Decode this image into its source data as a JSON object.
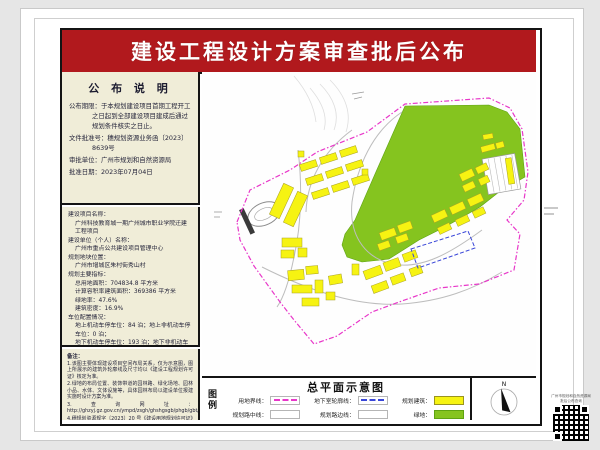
{
  "banner": {
    "title": "建设工程设计方案审查批后公布"
  },
  "notice": {
    "header": "公 布 说 明",
    "period_label": "公布期限：",
    "period_value": "于本规划建设项目首期工程开工之日起到全部建设项目建成后通过规划条件核实之日止。",
    "doc_no_label": "文件批准号：",
    "doc_no_value": "穗规划资源业务函〔2023〕8639号",
    "authority_label": "审批单位：",
    "authority_value": "广州市规划和自然资源局",
    "date_label": "批准日期：",
    "date_value": "2023年07月04日"
  },
  "project": {
    "name_label": "建设项目名称：",
    "name_value": "广州科技教育城一期广州城市职业学院迁建工程项目",
    "unit_label": "建设单位（个人）名称：",
    "unit_value": "广州市重点公共建设项目管理中心",
    "location_label": "规划地块位置：",
    "location_value": "广州市增城区朱村街秀山村",
    "indicators_label": "规划主要指标：",
    "land_area": "总用地面积：704834.8 平方米",
    "floor_area": "计算容积率建筑面积：369386 平方米",
    "green_ratio": "绿地率：47.6%",
    "density": "建筑密度：16.9%",
    "parking_label": "车位配置情况：",
    "parking_line1": "地上机动车停车位：84 泊；地上非机动车停车位：0 泊；",
    "parking_line2": "地下机动车停车位：193 泊；地下非机动车停车位：5992 泊；",
    "public_label": "公建配套项目：",
    "public_value": "无"
  },
  "remarks": {
    "header": "备注：",
    "items": [
      "1.该图主要体现建设项目空间布局关系，仅为示意图，图上所展示的建筑外轮廓线及尺寸均以《建设工程规划许可证》核定为准。",
      "2.绿地的布局位置、装饰带道的园林路、绿化场地、园林小品、水体、文体设施等，具体园林布局以建设单位报建实施时设计方案为准。",
      "3.查询网址： http://ghzyj.gz.gov.cn/ympd/zsgh/ghshgsgb/phgb/gbt/",
      "4.穗规划资源规字〔2023〕20 号《建设用地规划许可证》所规定其他范围内需建设工程规划许可的以穗规划资源业务函〔2023〕8639 号批复方案为准。"
    ]
  },
  "plan": {
    "title": "总平面示意图"
  },
  "legend": {
    "label": "图例",
    "items": [
      {
        "name": "用地界线：",
        "type": "dash-magenta",
        "color": "#e837c9"
      },
      {
        "name": "地下室轮廓线：",
        "type": "dash-blue",
        "color": "#3946d8"
      },
      {
        "name": "规划建筑：",
        "type": "fill",
        "color": "#f6f312"
      },
      {
        "name": "规划路中线：",
        "type": "box",
        "color": "#ffffff"
      },
      {
        "name": "规划路边线：",
        "type": "box",
        "color": "#ffffff"
      },
      {
        "name": "绿地：",
        "type": "fill",
        "color": "#85c41f"
      }
    ],
    "north_label": "N"
  },
  "qr": {
    "caption_line1": "广州市规划和自然资源局",
    "caption_line2": "批后公布查询"
  },
  "colors": {
    "banner_red": "#b1191d",
    "panel_cream": "#f0edd8",
    "map_green": "#85c41f",
    "building_yellow": "#f6f312",
    "boundary_magenta": "#e837c9",
    "underground_blue": "#3946d8"
  }
}
